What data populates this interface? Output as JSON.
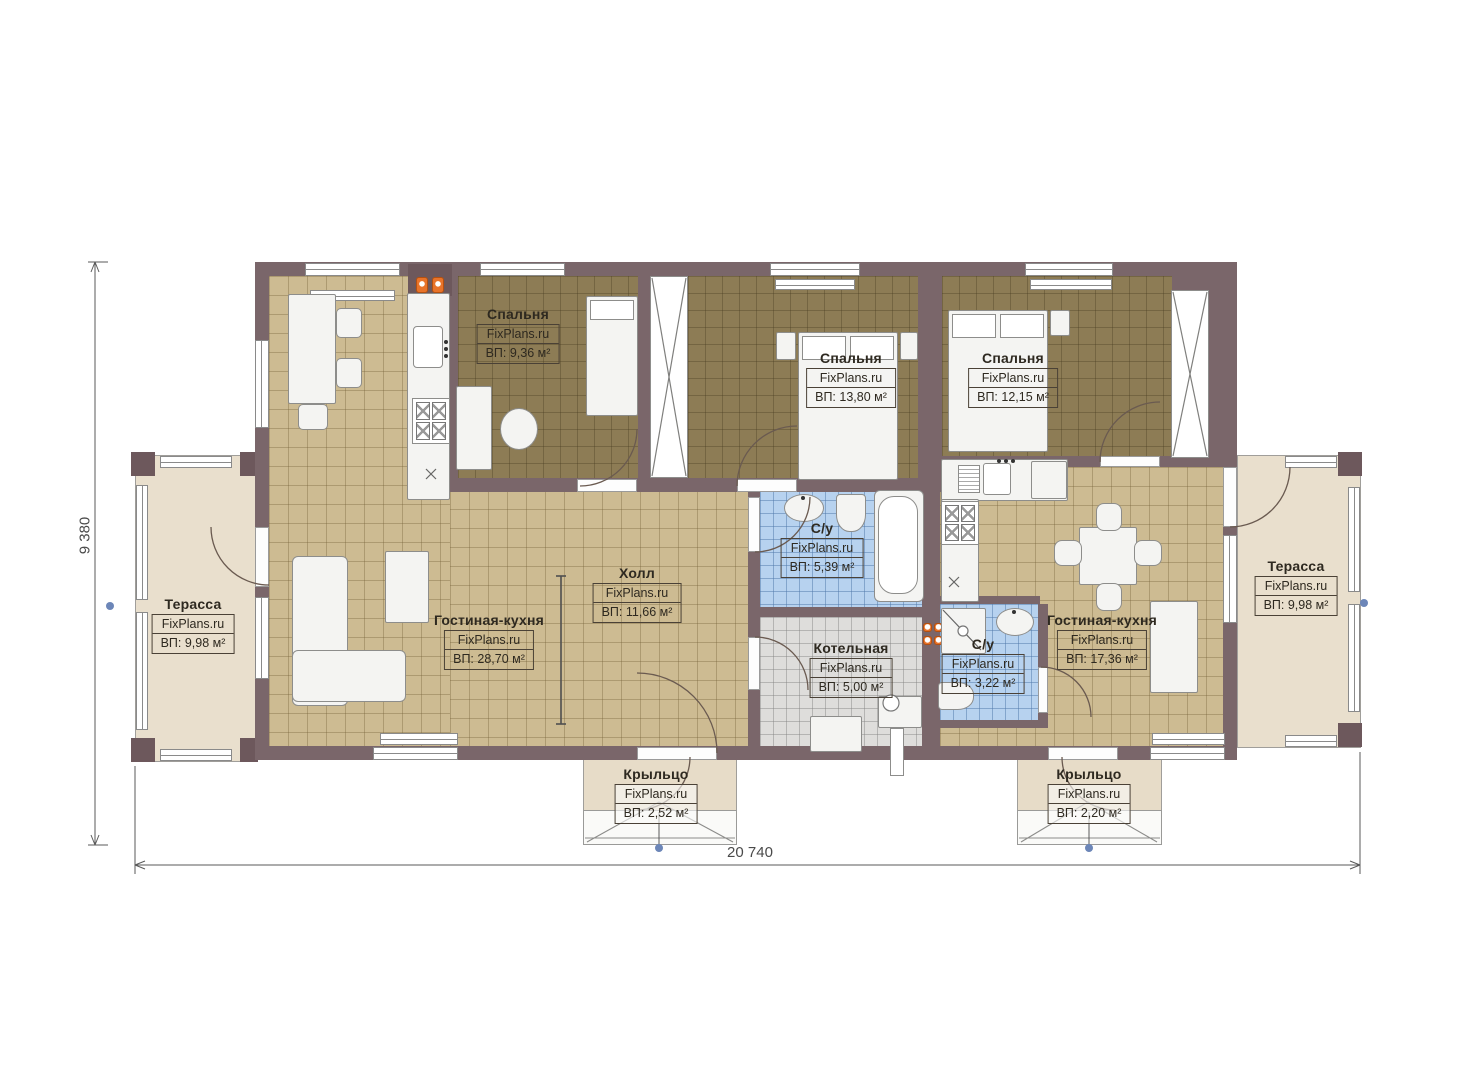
{
  "rooms": [
    {
      "name": "Спальня",
      "watermark": "FixPlans.ru",
      "area": "ВП: 9,36 м²"
    },
    {
      "name": "Спальня",
      "watermark": "FixPlans.ru",
      "area": "ВП: 13,80 м²"
    },
    {
      "name": "Спальня",
      "watermark": "FixPlans.ru",
      "area": "ВП: 12,15 м²"
    },
    {
      "name": "Холл",
      "watermark": "FixPlans.ru",
      "area": "ВП: 11,66 м²"
    },
    {
      "name": "С/у",
      "watermark": "FixPlans.ru",
      "area": "ВП: 5,39 м²"
    },
    {
      "name": "Котельная",
      "watermark": "FixPlans.ru",
      "area": "ВП: 5,00 м²"
    },
    {
      "name": "С/у",
      "watermark": "FixPlans.ru",
      "area": "ВП: 3,22 м²"
    },
    {
      "name": "Гостиная-кухня",
      "watermark": "FixPlans.ru",
      "area": "ВП: 28,70 м²"
    },
    {
      "name": "Гостиная-кухня",
      "watermark": "FixPlans.ru",
      "area": "ВП: 17,36 м²"
    },
    {
      "name": "Терасса",
      "watermark": "FixPlans.ru",
      "area": "ВП: 9,98 м²"
    },
    {
      "name": "Терасса",
      "watermark": "FixPlans.ru",
      "area": "ВП: 9,98 м²"
    },
    {
      "name": "Крыльцо",
      "watermark": "FixPlans.ru",
      "area": "ВП: 2,52 м²"
    },
    {
      "name": "Крыльцо",
      "watermark": "FixPlans.ru",
      "area": "ВП: 2,20 м²"
    }
  ],
  "dimensions": {
    "overall_width": "20 740",
    "overall_height": "9 380"
  },
  "colors": {
    "wall": "#7a666a",
    "floor_tan": "#cdbb92",
    "floor_bedroom": "#8d7c55",
    "floor_bath": "#b7d2ef",
    "floor_boiler": "#dedddb",
    "terrace": "#e9dfcd",
    "accent_orange": "#e8732a",
    "marker_blue": "#6c86b8"
  }
}
